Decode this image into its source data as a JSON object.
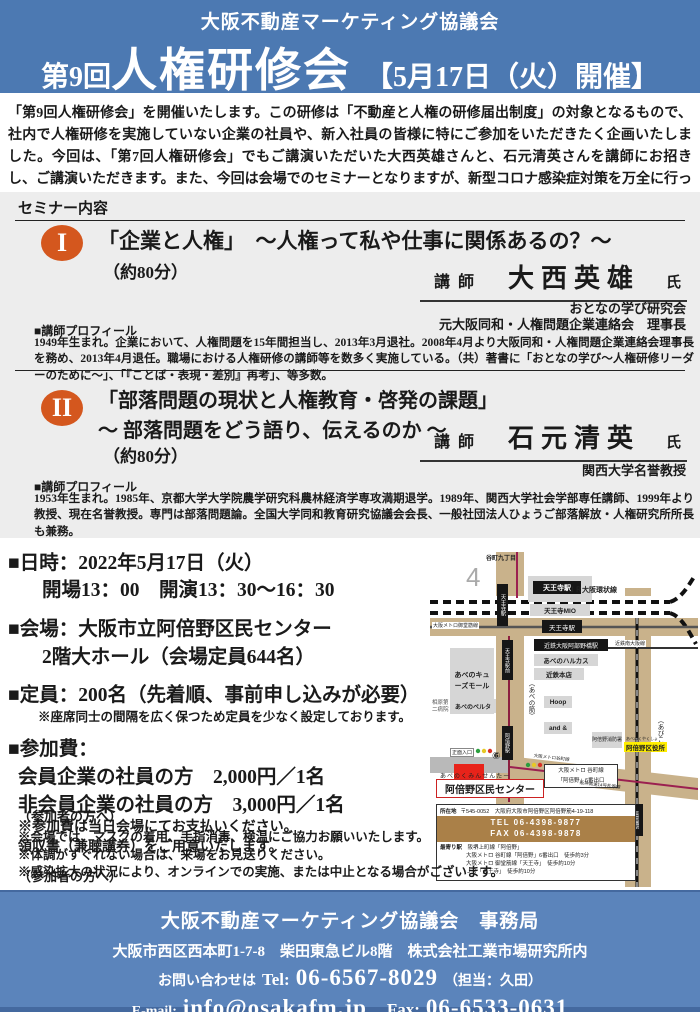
{
  "colors": {
    "header_blue": "#4c79b2",
    "footer_blue": "#5b84bb",
    "accent_orange": "#d4571e",
    "destination_red": "#e8231a",
    "highlight_yellow": "#ffee00",
    "road_tan": "#c9b28b",
    "info_bar_brown": "#aa8048"
  },
  "header": {
    "org": "大阪不動産マーケティング協議会",
    "title_prefix": "第9回",
    "title_main": "人権研修会",
    "title_date": "【5月17日（火）開催】"
  },
  "intro": "「第9回人権研修会」を開催いたします。この研修は「不動産と人権の研修届出制度」の対象となるもので、社内で人権研修を実施していない企業の社員や、新入社員の皆様に特にご参加をいただきたく企画いたしました。今回は、「第7回人権研修会」でもご講演いただいた大西英雄さんと、石元清英さんを講師にお招きし、ご講演いただきます。また、今回は会場でのセミナーとなりますが、新型コロナ感染症対策を万全に行っております。ぜひ、ご参加くださいますようお願いいたします。",
  "seminar_section": {
    "label": "セミナー内容",
    "seminar1": {
      "num": "I",
      "title": "「企業と人権」　～人権って私や仕事に関係あるの？～",
      "duration": "（約80分）",
      "lecturer_label": "講師",
      "lecturer_name": "大西英雄",
      "honorific": "氏",
      "affiliation1": "おとなの学び研究会",
      "affiliation2": "元大阪同和・人権問題企業連絡会　理事長",
      "profile_label": "■講師プロフィール",
      "profile": "1949年生まれ。企業において、人権問題を15年間担当し、2013年3月退社。2008年4月より大阪同和・人権問題企業連絡会理事長を務め、2013年4月退任。職場における人権研修の講師等を数多く実施している。（共）著書に「おとなの学び～人権研修リーダーのために～」、「『ことば・表現・差別』再考」、等多数。"
    },
    "seminar2": {
      "num": "II",
      "title_line1": "「部落問題の現状と人権教育・啓発の課題」",
      "title_line2": "～ 部落問題をどう語り、伝えるのか ～",
      "duration": "（約80分）",
      "lecturer_label": "講師",
      "lecturer_name": "石元清英",
      "honorific": "氏",
      "affiliation1": "関西大学名誉教授",
      "profile_label": "■講師プロフィール",
      "profile": "1953年生まれ。1985年、京都大学大学院農学研究科農林経済学専攻満期退学。1989年、関西大学社会学部専任講師、1999年より教授、現在名誉教授。専門は部落問題論。全国大学同和教育研究協議会会長、一般社団法人ひょうご部落解放・人権研究所所長も兼務。"
    }
  },
  "details": {
    "datetime_head": "■日時：2022年5月17日（火）",
    "datetime_sub": "開場13：00　開演13：30～16：30",
    "venue_head": "■会場：大阪市立阿倍野区民センター",
    "venue_sub": "2階大ホール（会場定員644名）",
    "capacity_head": "■定員：200名（先着順、事前申し込みが必要）",
    "capacity_note": "※座席同士の間隔を広く保つため定員を少なく設定しております。",
    "fee_head": "■参加費：",
    "fee_member": "会員企業の社員の方　2,000円／1名",
    "fee_nonmember": "非会員企業の社員の方　3,000円／1名",
    "fee_note1": "※参加費は当日会場にてお支払いください。",
    "fee_note2": "領収書（兼聴講券）をご用意いたします。",
    "attendee_head": "（参加者の方へ）",
    "attendee_notes": [
      "※会場では、マスクの着用、手指消毒、検温にご協力お願いいたします。",
      "※体調がすぐれない場合は、来場をお見送りください。",
      "※感染拡大の状況により、オンラインでの実施、または中止となる場合がございます。"
    ]
  },
  "map": {
    "labels": {
      "area_number": "4",
      "tanimachi9": "谷町九丁目",
      "jr_station": "天王寺駅",
      "jr_loop": "ＪＲ大阪環状線",
      "mio": "天王寺MIO",
      "metro_station": "天王寺駅",
      "midosuji": "大阪メトロ御堂筋線",
      "tanimachi_vertical": "天王寺駅",
      "kintetsu_station": "近鉄大阪阿部野橋駅",
      "kintetsu_line": "近鉄南大阪線",
      "harukas": "あべのハルカス",
      "kintetsu_store": "近鉄本店",
      "hoop": "Hoop",
      "and_bldg": "and &",
      "qs_mall": "あべのキューズモール",
      "abeno_suji": "（あべの筋）",
      "abiko_suji": "（あびこ筋）",
      "tram_stop": "天王寺駅前",
      "abeno_stop": "阿倍野駅",
      "belta": "あべのベルタ",
      "hospital": "相原第二病院",
      "entrance": "正面入口",
      "exit6": "⑥",
      "center_kana": "あべのくみんせんたー",
      "center": "阿倍野区民センター",
      "exit_callout1": "大阪メトロ 谷町線",
      "exit_callout2": "「阿倍野」6番出口",
      "fire": "阿倍野消防署",
      "ward_kana": "あべのくやくしょ",
      "ward": "阿倍野区役所",
      "metro_diag": "大阪メトロ谷町線",
      "expressway": "阪神高速14号松原線",
      "bisyoen": "美章園駅"
    },
    "info": {
      "address_label": "所在地",
      "address": "〒545-0052　大阪府大阪市阿倍野区阿倍野筋4-19-118",
      "tel": "TEL 06-4398-9877",
      "fax": "FAX 06-4398-9878",
      "nearest_label": "最寄り駅",
      "nearest1": "阪堺上町線「阿倍野」",
      "nearest2": "大阪メトロ 谷町線「阿倍野」6番出口　徒歩約3分",
      "nearest3": "大阪メトロ 御堂筋線「天王寺」　徒歩約10分",
      "nearest4": "ＪＲ「天王寺」　徒歩約10分"
    }
  },
  "footer": {
    "line1": "大阪不動産マーケティング協議会　事務局",
    "line2": "大阪市西区西本町1-7-8　柴田東急ビル8階　株式会社工業市場研究所内",
    "contact_prefix": "お問い合わせは",
    "tel_label": "Tel:",
    "tel": "06-6567-8029",
    "tel_note": "（担当：久田）",
    "email_label": "E-mail:",
    "email": "info@osakafm.jp",
    "fax_label": "Fax:",
    "fax": "06-6533-0631"
  }
}
